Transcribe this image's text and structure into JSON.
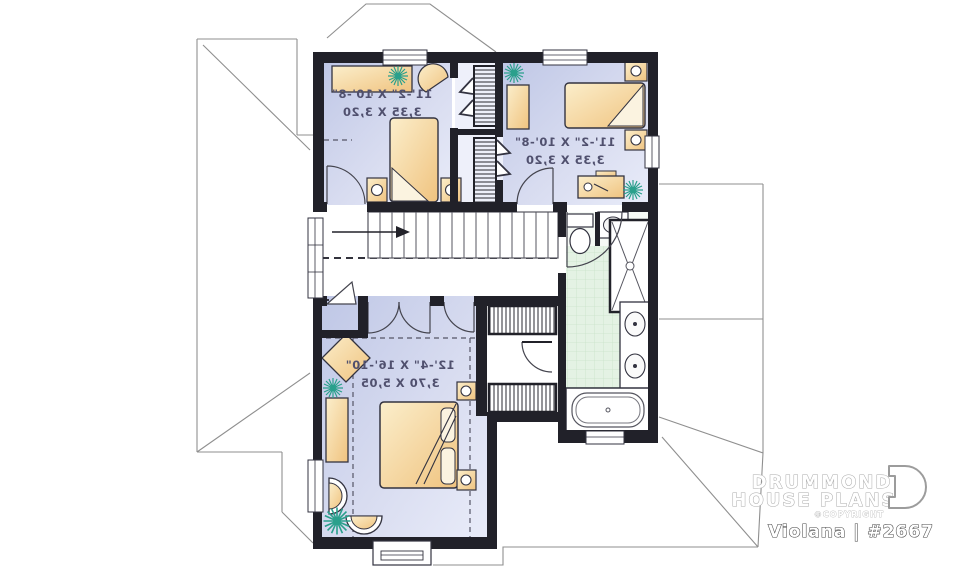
{
  "brand": {
    "line1": "DRUMMOND",
    "line2": "HOUSE PLANS",
    "copyright": "©COPYRIGHT",
    "plan_label": "Violana | #2667"
  },
  "rooms": [
    {
      "id": "bedroom-top-left",
      "imperial": "11'-2\" X 10'-8\"",
      "metric": "3,35 X 3,20"
    },
    {
      "id": "bedroom-top-right",
      "imperial": "11'-2\" X 10'-8\"",
      "metric": "3,35 X 3,20"
    },
    {
      "id": "master-bedroom",
      "imperial": "12'-4\" X 16'-10\"",
      "metric": "3,70 X 5,05"
    }
  ],
  "colors": {
    "wall": "#212129",
    "floor_light": "#e7eaf8",
    "floor_dark": "#c2cae8",
    "furniture": "#f2cd92",
    "bath_tile": "#e4f2e4",
    "plant": "#2aa08c"
  }
}
